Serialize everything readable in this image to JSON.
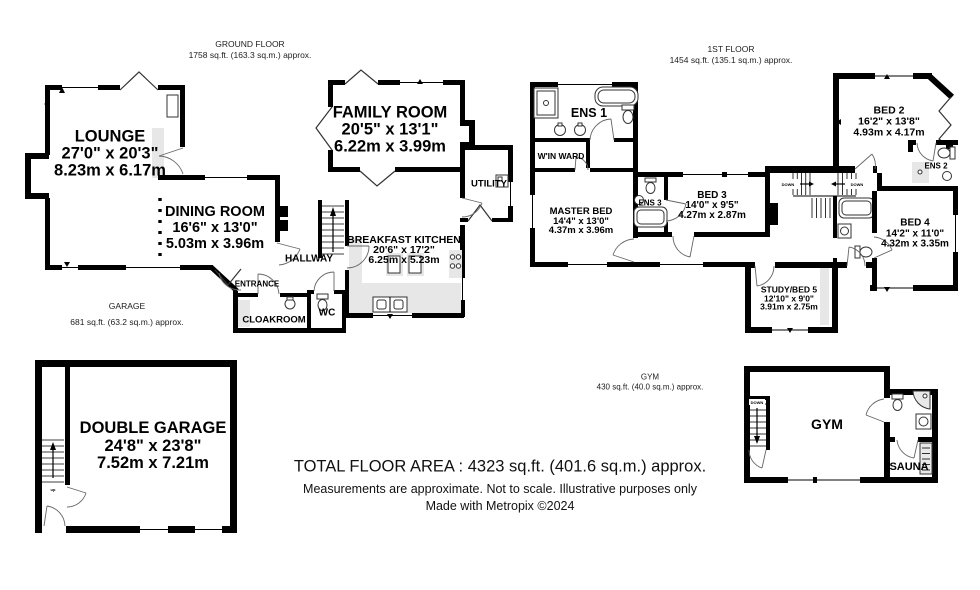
{
  "document": {
    "background": "#ffffff",
    "wall_color": "#000000",
    "shading_gray": "#e7e7e7"
  },
  "sections": {
    "ground_floor": {
      "title": "GROUND FLOOR",
      "area": "1758 sq.ft. (163.3 sq.m.) approx."
    },
    "first_floor": {
      "title": "1ST FLOOR",
      "area": "1454 sq.ft. (135.1 sq.m.) approx."
    },
    "garage": {
      "title": "GARAGE",
      "area": "681 sq.ft. (63.2 sq.m.) approx."
    },
    "gym": {
      "title": "GYM",
      "area": "430 sq.ft. (40.0 sq.m.) approx."
    }
  },
  "rooms": {
    "lounge": {
      "name": "LOUNGE",
      "imperial": "27'0\" x 20'3\"",
      "metric": "8.23m x 6.17m"
    },
    "dining_room": {
      "name": "DINING ROOM",
      "imperial": "16'6\" x 13'0\"",
      "metric": "5.03m x 3.96m"
    },
    "family_room": {
      "name": "FAMILY ROOM",
      "imperial": "20'5\" x 13'1\"",
      "metric": "6.22m x 3.99m"
    },
    "breakfast_kitchen": {
      "name": "BREAKFAST KITCHEN",
      "imperial": "20'6\" x 17'2\"",
      "metric": "6.25m x 5.23m"
    },
    "utility": {
      "name": "UTILITY"
    },
    "hallway": {
      "name": "HALLWAY"
    },
    "entrance": {
      "name": "ENTRANCE"
    },
    "cloakroom": {
      "name": "CLOAKROOM"
    },
    "wc": {
      "name": "WC"
    },
    "double_garage": {
      "name": "DOUBLE GARAGE",
      "imperial": "24'8\" x 23'8\"",
      "metric": "7.52m x 7.21m"
    },
    "ens1": {
      "name": "ENS 1"
    },
    "win_ward": {
      "name": "W'IN WARD"
    },
    "master_bed": {
      "name": "MASTER BED",
      "imperial": "14'4\" x 13'0\"",
      "metric": "4.37m x 3.96m"
    },
    "ens3": {
      "name": "ENS 3"
    },
    "bed3": {
      "name": "BED 3",
      "imperial": "14'0\" x 9'5\"",
      "metric": "4.27m x 2.87m"
    },
    "bed2": {
      "name": "BED 2",
      "imperial": "16'2\" x 13'8\"",
      "metric": "4.93m x 4.17m"
    },
    "ens2": {
      "name": "ENS 2"
    },
    "bed4": {
      "name": "BED 4",
      "imperial": "14'2\" x 11'0\"",
      "metric": "4.32m x 3.35m"
    },
    "study_bed5": {
      "name": "STUDY/BED 5",
      "imperial": "12'10\" x 9'0\"",
      "metric": "3.91m x 2.75m"
    },
    "gym_room": {
      "name": "GYM"
    },
    "sauna": {
      "name": "SAUNA"
    }
  },
  "stair_labels": {
    "down": "DOWN",
    "up": "up"
  },
  "footer": {
    "total": "TOTAL FLOOR AREA : 4323 sq.ft. (401.6 sq.m.) approx.",
    "disclaimer": "Measurements are approximate.  Not to scale.  Illustrative purposes only",
    "credit": "Made with Metropix ©2024"
  }
}
